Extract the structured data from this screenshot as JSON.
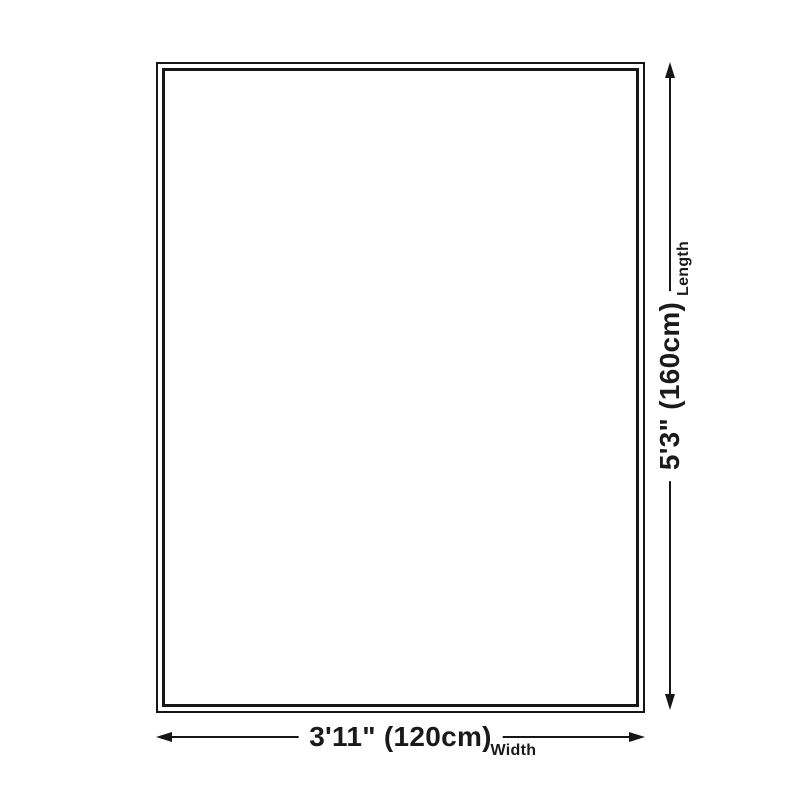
{
  "page": {
    "background": "#ffffff",
    "line_color": "#161616",
    "text_color": "#1a1a1a"
  },
  "diagram": {
    "kind": "product-size-diagram",
    "shape": "rectangle-double-border",
    "dimensions": {
      "width": {
        "value": "3'11\" (120cm)",
        "label": "Width",
        "cm": 120,
        "feet_inches": "3'11\""
      },
      "length": {
        "value": "5'3\" (160cm)",
        "label": "Length",
        "cm": 160,
        "feet_inches": "5'3\""
      }
    }
  }
}
